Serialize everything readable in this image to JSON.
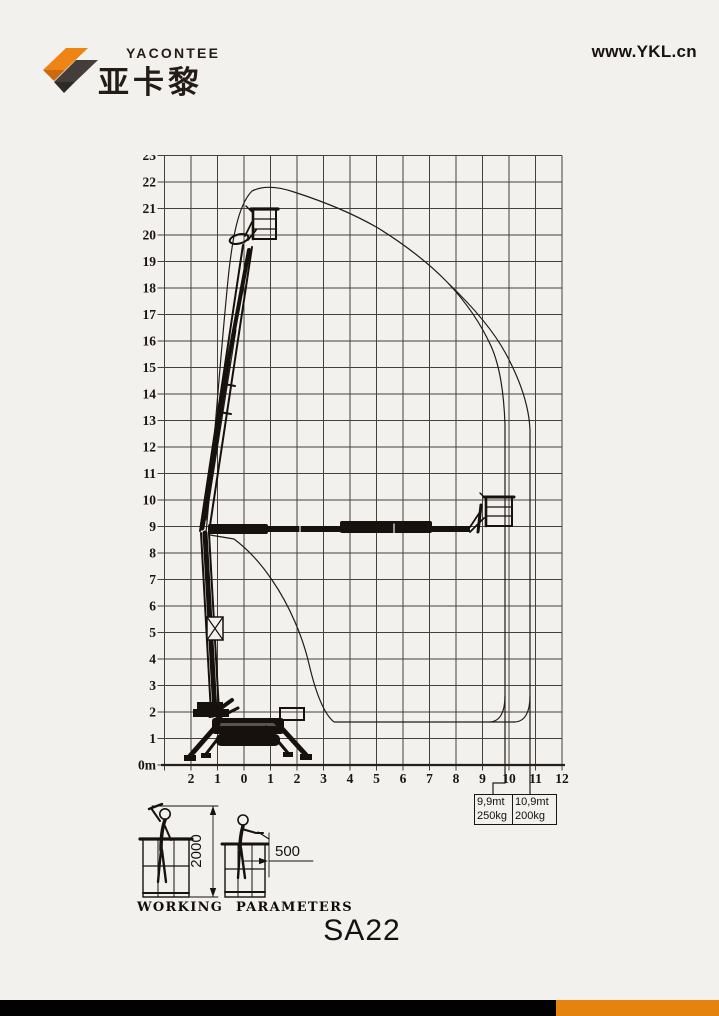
{
  "header": {
    "brand_name": "YACONTEE",
    "brand_cn": "亚卡黎",
    "website": "www.YKL.cn"
  },
  "chart": {
    "y_ticks": [
      "23",
      "22",
      "21",
      "20",
      "19",
      "18",
      "17",
      "16",
      "15",
      "14",
      "13",
      "12",
      "11",
      "10",
      "9",
      "8",
      "7",
      "6",
      "5",
      "4",
      "3",
      "2",
      "1",
      "0m"
    ],
    "x_ticks": [
      "2",
      "1",
      "0",
      "1",
      "2",
      "3",
      "4",
      "5",
      "6",
      "7",
      "8",
      "9",
      "10",
      "11",
      "12"
    ],
    "callouts": [
      {
        "line1": "9,9mt",
        "line2": "250kg"
      },
      {
        "line1": "10,9mt",
        "line2": "200kg"
      }
    ]
  },
  "working": {
    "caption": "WORKING PARAMETERS",
    "height_mm": "2000",
    "reach_mm": "500"
  },
  "model": {
    "name": "SA22"
  },
  "colors": {
    "background": "#f2f1ee",
    "brand_orange": "#ee8413",
    "brand_orange_dark": "#c96a0c",
    "brand_gray": "#443e3a",
    "footer_black": "#020202",
    "footer_orange": "#e5830f"
  },
  "chart_data": {
    "type": "area",
    "title": "SA22 working envelope diagram",
    "x_axis_m": [
      -2,
      -1,
      0,
      1,
      2,
      3,
      4,
      5,
      6,
      7,
      8,
      9,
      10,
      11,
      12
    ],
    "y_axis_m": [
      0,
      1,
      2,
      3,
      4,
      5,
      6,
      7,
      8,
      9,
      10,
      11,
      12,
      13,
      14,
      15,
      16,
      17,
      18,
      19,
      20,
      21,
      22,
      23
    ],
    "grid": true,
    "max_platform_floor_height_m": 20,
    "max_envelope_height_m": 21.8,
    "outreach_limits": [
      {
        "outreach_m": 9.9,
        "capacity_kg": 250
      },
      {
        "outreach_m": 10.9,
        "capacity_kg": 200
      }
    ],
    "envelope_outline_m": [
      [
        -1.5,
        8.8
      ],
      [
        -0.8,
        15.0
      ],
      [
        -0.5,
        19.5
      ],
      [
        0.3,
        21.8
      ],
      [
        1.9,
        21.6
      ],
      [
        4.0,
        20.6
      ],
      [
        7.7,
        18.2
      ],
      [
        9.0,
        16.0
      ],
      [
        9.85,
        12.8
      ],
      [
        9.85,
        1.6
      ],
      [
        3.4,
        1.6
      ],
      [
        2.5,
        3.8
      ],
      [
        1.0,
        6.8
      ],
      [
        -0.4,
        8.7
      ]
    ],
    "envelope_outline_outer_branch_m": [
      [
        7.7,
        18.2
      ],
      [
        9.9,
        15.5
      ],
      [
        10.8,
        12.6
      ],
      [
        10.8,
        1.6
      ],
      [
        9.85,
        1.6
      ]
    ],
    "worker_height_dim_mm": 2000,
    "worker_reach_dim_mm": 500
  }
}
